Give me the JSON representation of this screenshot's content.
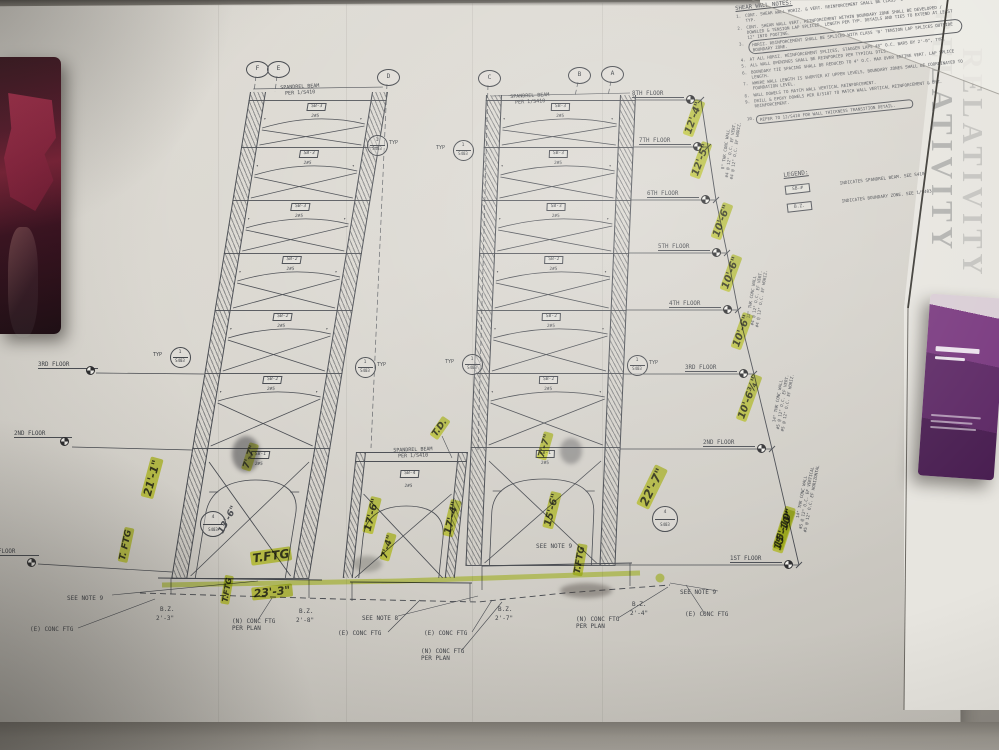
{
  "sheet": {
    "side_title": "RELATIVITY",
    "accent_highlight": "#dfe948",
    "line_color": "#45484e",
    "paper_color": "#d9d6cf"
  },
  "notes": {
    "title": "SHEAR WALL NOTES:",
    "items": [
      {
        "num": "1.",
        "text": "CONT. SHEAR WALL HORIZ. & VERT. REINFORCEMENT SHALL BE CLASS 'B' TENSION LAP SPLICED, TYP."
      },
      {
        "num": "2.",
        "text": "CONT. SHEAR WALL VERT. REINFORCEMENT WITHIN BOUNDARY ZONE SHALL BE DEVELOPED / DOWELED & TENSION LAP SPLICED, LENGTH PER TYP. DETAILS AND TIES TO EXTEND AT LEAST 12\" INTO FOOTING."
      },
      {
        "num": "3.",
        "text": "HORIZ. REINFORCEMENT SHALL BE SPLICED WITH CLASS 'B' TENSION LAP SPLICES OUTSIDE BOUNDARY ZONE.",
        "cloud": true
      },
      {
        "num": "4.",
        "text": "AT ALL HORIZ. REINFORCEMENT SPLICES, STAGGER LAPS 48\" O.C. BARS BY 2'-0\", TYP."
      },
      {
        "num": "5.",
        "text": "ALL WALL OPENINGS SHALL BE REINFORCED PER TYPICAL DTLS."
      },
      {
        "num": "6.",
        "text": "BOUNDARY TIE SPACING SHALL BE REDUCED TO 4\" O.C. MAX OVER ENTIRE VERT. LAP SPLICE LENGTH."
      },
      {
        "num": "7.",
        "text": "WHERE WALL LENGTH IS SHORTER AT UPPER LEVELS, BOUNDARY ZONES SHALL BE COORDINATED TO FOUNDATION LEVEL."
      },
      {
        "num": "8.",
        "text": "WALL DOWELS TO MATCH WALL VERTICAL REINFORCEMENT."
      },
      {
        "num": "9.",
        "text": "DRILL & EPOXY DOWELS PER 8/S107 TO MATCH WALL VERTICAL REINFORCEMENT & B.Z. REINFORCEMENT."
      },
      {
        "num": "10.",
        "text": "REFER TO 12/S410 FOR WALL THICKNESS TRANSITION DETAIL.",
        "boxed": true
      }
    ]
  },
  "legend": {
    "title": "LEGEND:",
    "items": [
      {
        "symbol": "SB-#",
        "description": "INDICATES SPANDREL BEAM. SEE S410"
      },
      {
        "symbol": "B.Z.",
        "description": "INDICATES BOUNDARY ZONE. SEE 1/S403"
      }
    ]
  },
  "grids": [
    "F",
    "E",
    "D",
    "C",
    "B",
    "A"
  ],
  "floors_right": [
    "8TH FLOOR",
    "7TH FLOOR",
    "6TH FLOOR",
    "5TH FLOOR",
    "4TH FLOOR",
    "3RD FLOOR",
    "2ND FLOOR",
    "1ST FLOOR"
  ],
  "floors_left": [
    "3RD FLOOR",
    "2ND FLOOR",
    "1ST FLOOR"
  ],
  "story_dims": [
    "12'-4\"",
    "12'-5\"",
    "10'-6\"",
    "10'-6\"",
    "10'-6\"",
    "10'-6¾\"",
    "15'-10\""
  ],
  "wall_notes": [
    [
      "8\" THK CONC WALL",
      "#4 @ 12\" O.C. EF VERT.",
      "#4 @ 12\" O.C. EF HORIZ."
    ],
    [
      "12\" THK CONC WALL",
      "#4 @ 12\" O.C. EF VERT.",
      "#4 @ 12\" O.C. EF HORIZ."
    ],
    [
      "14\" THK CONC WALL",
      "#5 @ 12\" O.C. EF VERT.",
      "#5 @ 12\" O.C. EF HORIZ."
    ],
    [
      "14\" THK CONC WALL",
      "#5 @ 12\" O.C. EF VERTICAL",
      "#5 @ 12\" O.C. EF HORIZONTAL"
    ]
  ],
  "towers": {
    "left_sb": [
      "SB-3",
      "SB-3",
      "SB-3",
      "SB-2",
      "SB-2",
      "SB-2",
      "SB-1"
    ],
    "right_sb": [
      "SB-3",
      "SB-3",
      "SB-3",
      "SB-2",
      "SB-2",
      "SB-2",
      "SB-1"
    ],
    "center_sb": "SB-4",
    "rebar": "2#5"
  },
  "spandrel_note_lines": [
    "SPANDREL BEAM",
    "PER 1/S410"
  ],
  "details": {
    "nums": [
      "1",
      "1",
      "1",
      "1",
      "1",
      "1",
      "4",
      "4"
    ],
    "sheet": "S403",
    "typ": "TYP"
  },
  "bottom_labels": [
    "SEE NOTE 9",
    "(E) CONC FTG",
    "B.Z.",
    "2'-3\"",
    "(N) CONC FTG\nPER PLAN",
    "B.Z.",
    "2'-8\"",
    "SEE NOTE 8",
    "(E) CONC FTG",
    "(E) CONC FTG",
    "(N) CONC FTG\nPER PLAN",
    "B.Z.",
    "2'-7\"",
    "(N) CONC FTG\nPER PLAN",
    "B.Z.",
    "2'-4\"",
    "SEE NOTE 9",
    "(E) CONC FTG",
    "SEE NOTE 9"
  ],
  "annotations": [
    "21'-1\"",
    "T. FTG",
    "7'-7\"",
    "13'-6\"",
    "T.FTG",
    "23'-3\"",
    "T.FTG",
    "T.D.",
    "17'-6\"",
    "17'-4\"",
    "7'-4\"",
    "7'-7\"",
    "15'-6\"",
    "22'-7\"",
    "T.FTG",
    "15'-10\""
  ]
}
